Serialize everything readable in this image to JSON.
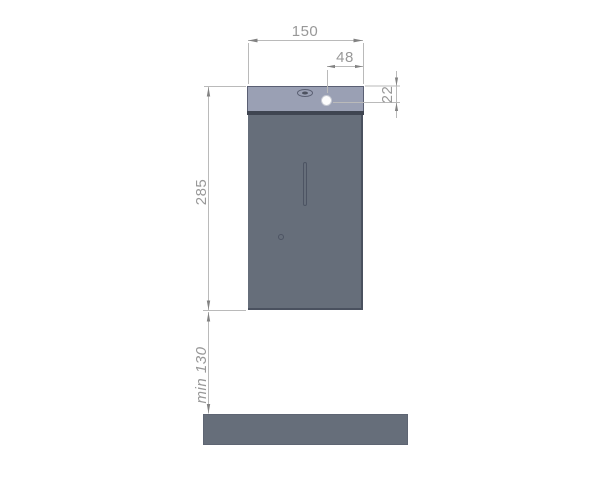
{
  "drawing": {
    "kind": "technical-dimension-drawing",
    "subject": "wall-mounted dispenser elevation with counter clearance",
    "labels": {
      "width": "150",
      "hole_offset": "48",
      "hole_from_top": "22",
      "height": "285",
      "clearance": "min 130"
    },
    "icons": {
      "lock": "lock-icon",
      "cap_hole": "indicator-hole",
      "slot": "level-window-slot",
      "pinhole": "pinhole"
    },
    "colors": {
      "background": "#ffffff",
      "cap": "#9aa0b4",
      "cap-band": "#3f4551",
      "body": "#666e7a",
      "edge": "#4a515f",
      "detail-outline": "#4d5463",
      "hole-fill": "#fdfdfd",
      "hole-rim": "#c6c9d2",
      "dim-line": "#bababa",
      "dim-arrow": "#828282",
      "dim-text": "#989898"
    }
  }
}
